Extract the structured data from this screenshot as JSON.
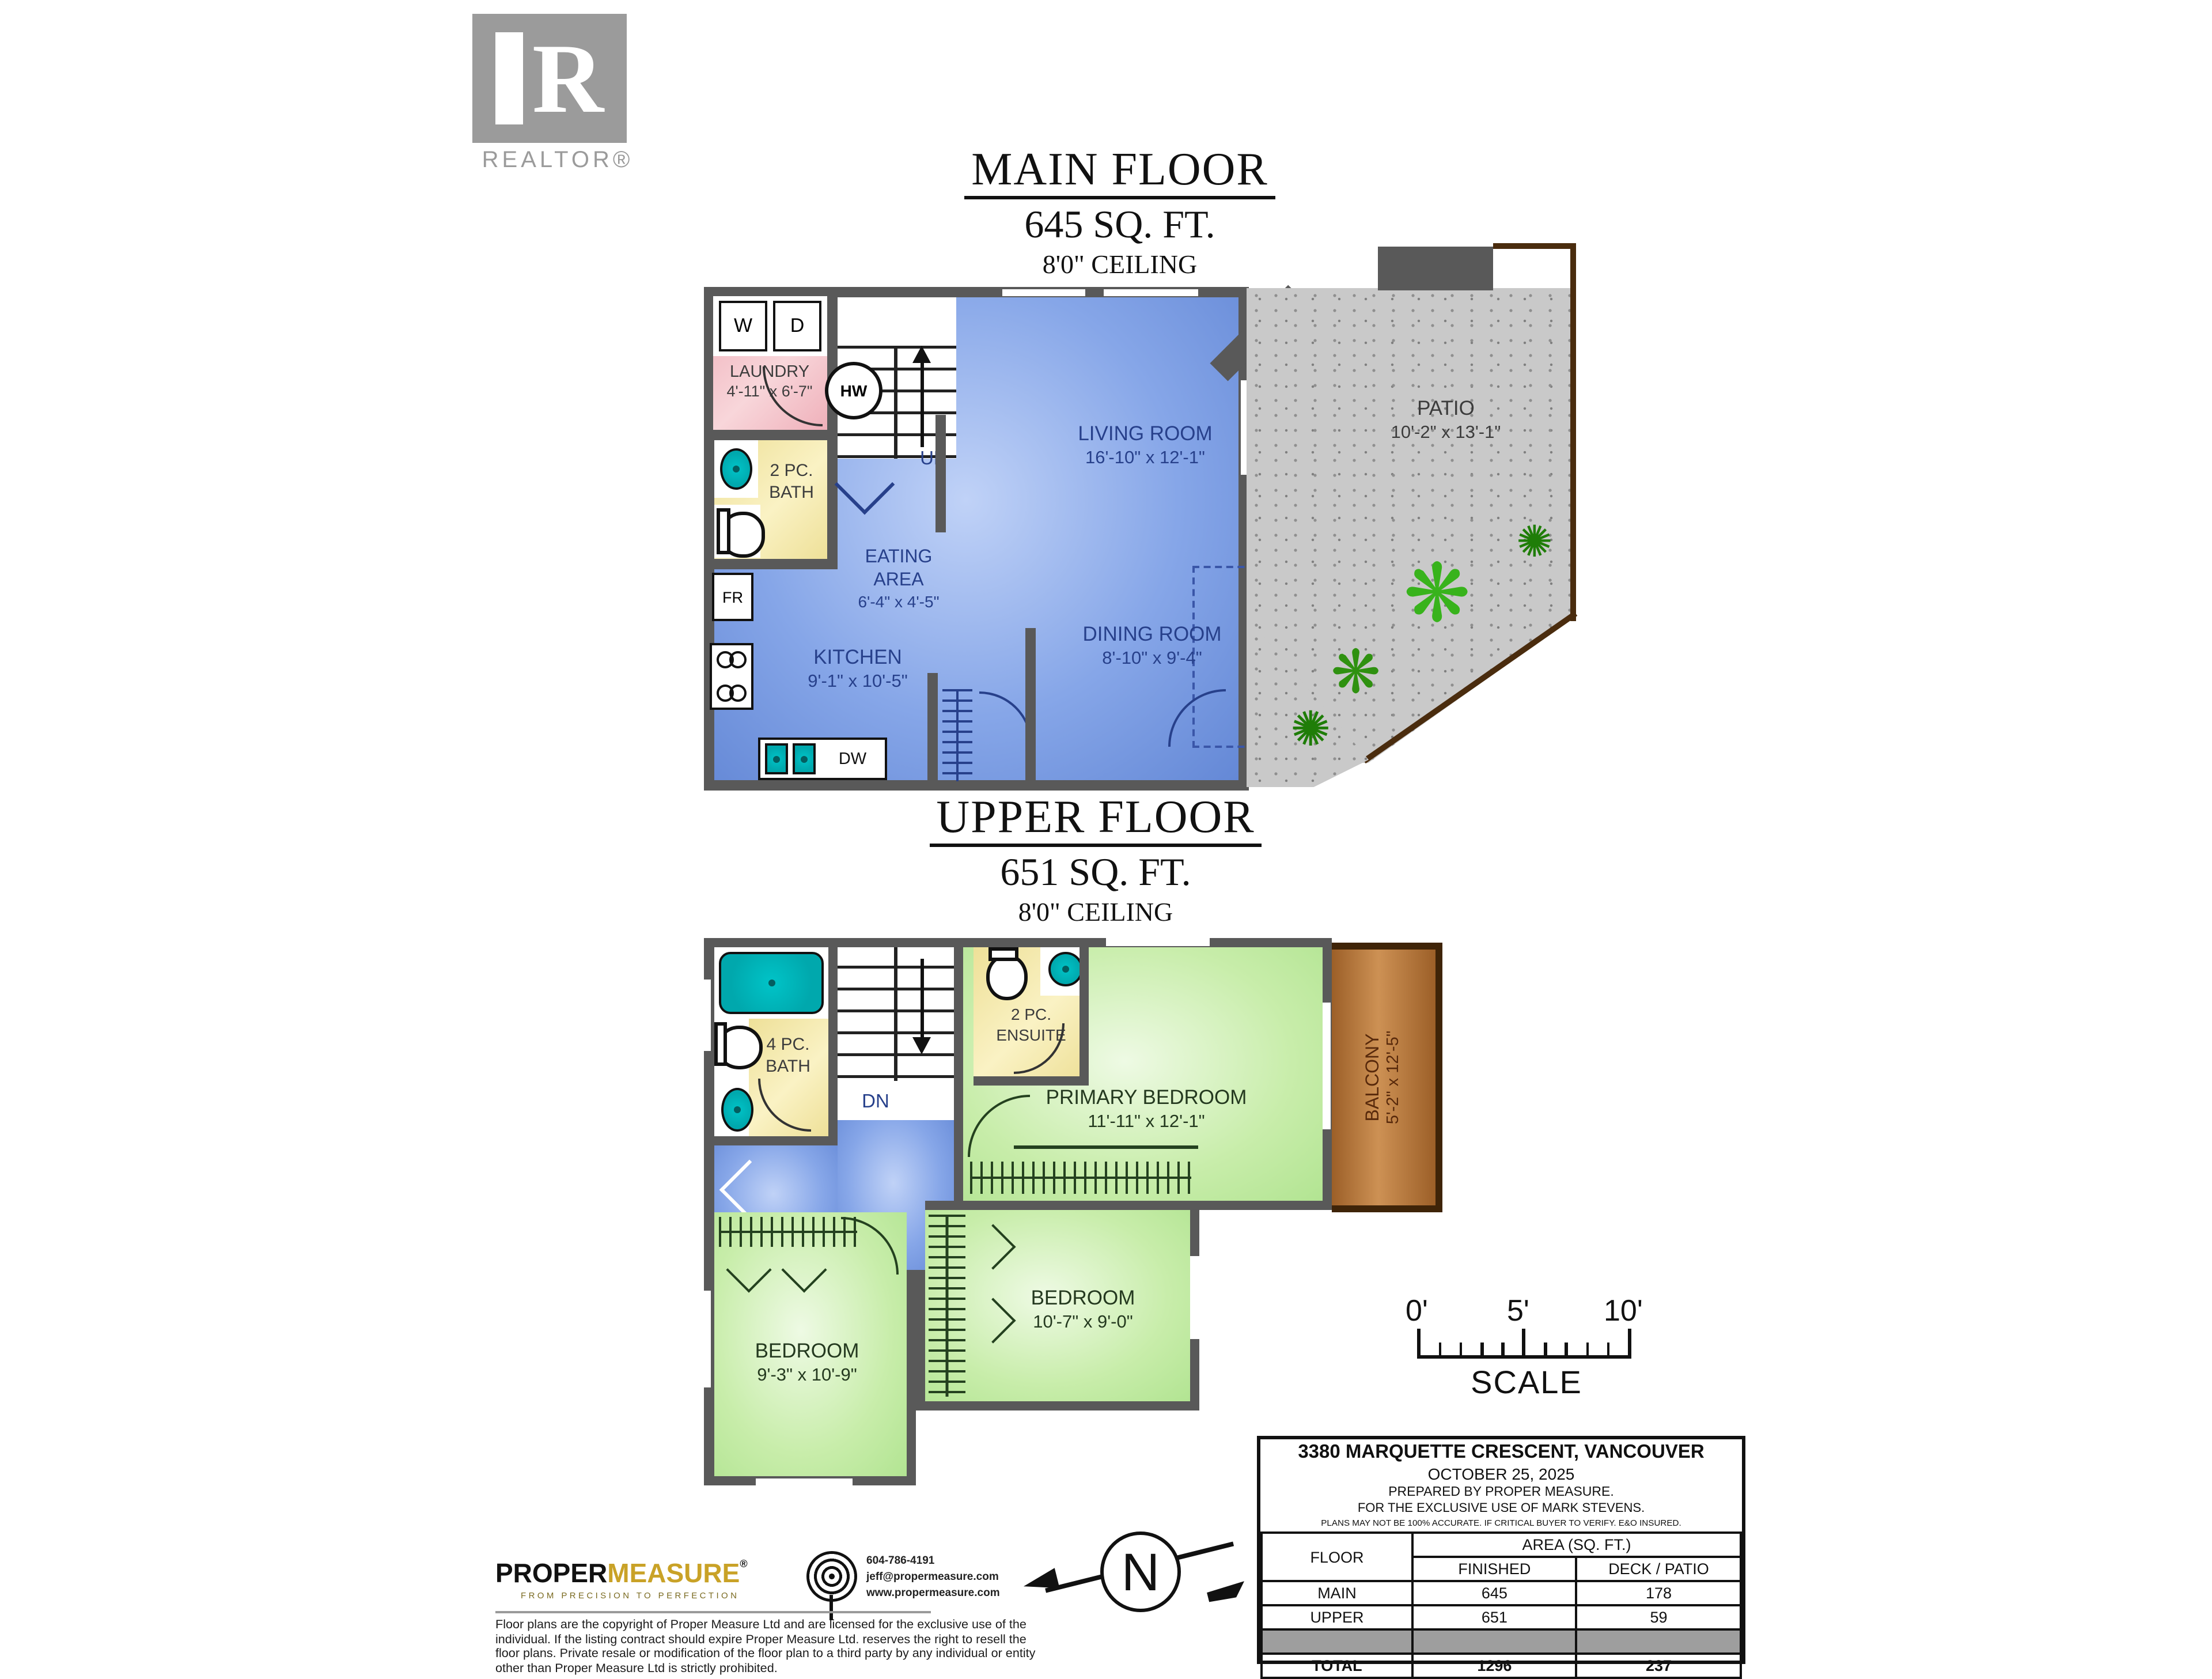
{
  "branding": {
    "realtor_r": "R",
    "realtor_wordmark": "REALTOR®"
  },
  "main_floor": {
    "title": "MAIN FLOOR",
    "area": "645 SQ. FT.",
    "ceiling": "8'0\" CEILING",
    "rooms": {
      "laundry": {
        "name": "LAUNDRY",
        "dims": "4'-11\" x 6'-7\""
      },
      "bath": {
        "line1": "2 PC.",
        "line2": "BATH"
      },
      "eating": {
        "line1": "EATING",
        "line2": "AREA",
        "dims": "6'-4\" x 4'-5\""
      },
      "kitchen": {
        "name": "KITCHEN",
        "dims": "9'-1\" x 10'-5\""
      },
      "living": {
        "name": "LIVING ROOM",
        "dims": "16'-10\" x 12'-1\""
      },
      "dining": {
        "name": "DINING ROOM",
        "dims": "8'-10\" x 9'-4\""
      },
      "patio": {
        "name": "PATIO",
        "dims": "10'-2\" x 13'-1\""
      }
    },
    "labels": {
      "washer": "W",
      "dryer": "D",
      "hot_water": "HW",
      "up": "UP",
      "fridge": "FR",
      "dishwasher": "DW"
    }
  },
  "upper_floor": {
    "title": "UPPER FLOOR",
    "area": "651 SQ. FT.",
    "ceiling": "8'0\" CEILING",
    "rooms": {
      "bath": {
        "line1": "4 PC.",
        "line2": "BATH"
      },
      "ensuite": {
        "line1": "2 PC.",
        "line2": "ENSUITE"
      },
      "primary": {
        "name": "PRIMARY BEDROOM",
        "dims": "11'-11\" x 12'-1\""
      },
      "balcony": {
        "name": "BALCONY",
        "dims": "5'-2\" x 12'-5\""
      },
      "bedroom2": {
        "name": "BEDROOM",
        "dims": "10'-7\" x 9'-0\""
      },
      "bedroom1": {
        "name": "BEDROOM",
        "dims": "9'-3\" x 10'-9\""
      }
    },
    "labels": {
      "down": "DN"
    }
  },
  "scale_bar": {
    "tick0": "0'",
    "tick5": "5'",
    "tick10": "10'",
    "label": "SCALE"
  },
  "north": {
    "label": "N"
  },
  "info_box": {
    "address": "3380 MARQUETTE CRESCENT, VANCOUVER",
    "date": "OCTOBER 25, 2025",
    "prepared": "PREPARED BY PROPER MEASURE.",
    "exclusive": "FOR THE EXCLUSIVE USE OF MARK STEVENS.",
    "disclaimer": "PLANS MAY NOT BE 100% ACCURATE. IF CRITICAL BUYER TO VERIFY. E&O INSURED.",
    "table": {
      "col_floor": "FLOOR",
      "col_area": "AREA (SQ. FT.)",
      "col_finished": "FINISHED",
      "col_deck": "DECK / PATIO",
      "rows": [
        [
          "MAIN",
          "645",
          "178"
        ],
        [
          "UPPER",
          "651",
          "59"
        ],
        [
          "TOTAL",
          "1296",
          "237"
        ]
      ]
    }
  },
  "footer": {
    "logo_black": "PROPER",
    "logo_gold": "MEASURE",
    "logo_reg": "®",
    "tagline": "FROM PRECISION TO PERFECTION",
    "phone": "604-786-4191",
    "email": "jeff@propermeasure.com",
    "web": "www.propermeasure.com",
    "copyright": "Floor plans are the copyright of Proper Measure Ltd and are licensed for the exclusive use of the individual.  If the listing contract should expire Proper Measure Ltd. reserves the right to resell the floor plans.  Private resale or modification of the floor plan to a third party by any individual or entity other than Proper Measure Ltd is strictly prohibited."
  },
  "colors": {
    "walls": "#595959",
    "living_blue": "#86a6e8",
    "bedroom_green": "#c8edaa",
    "bath_yellow": "#eee098",
    "laundry_pink": "#efb0ba",
    "patio_gray": "#c9c9c9",
    "balcony_brown": "#9c5f28",
    "fixture_teal": "#00a8ad",
    "label_navy": "#27408b",
    "logo_gold": "#c9a227"
  }
}
